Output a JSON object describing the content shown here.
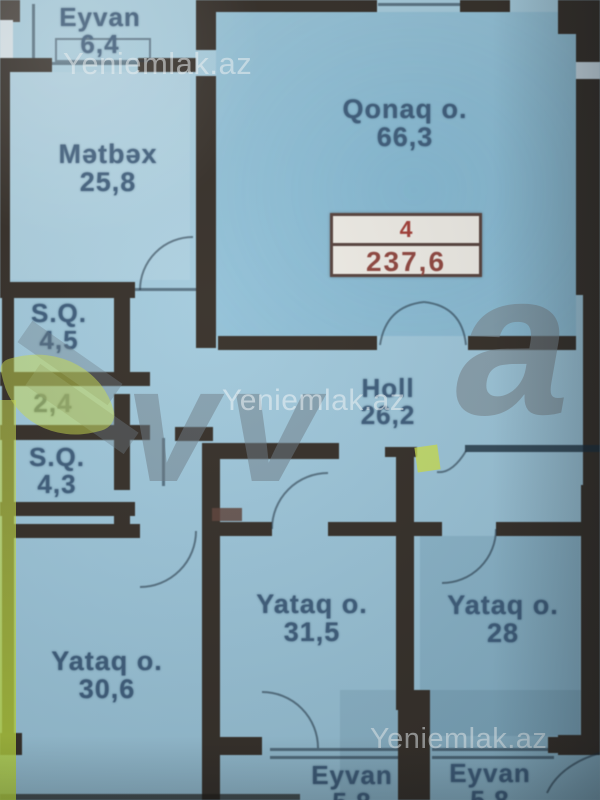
{
  "watermark": {
    "site": "Yeniemlak.az",
    "logo_v": "v",
    "logo_a": "a"
  },
  "badge": {
    "line1": "4",
    "line2": "237,6"
  },
  "rooms": {
    "eyvan_top": {
      "name": "Eyvan",
      "area": "6,4"
    },
    "metbex": {
      "name": "Mətbəx",
      "area": "25,8"
    },
    "qonaq": {
      "name": "Qonaq o.",
      "area": "66,3"
    },
    "sq1": {
      "name": "S.Q.",
      "area": "4,5"
    },
    "dehliz": {
      "area": "2,4"
    },
    "sq2": {
      "name": "S.Q.",
      "area": "4,3"
    },
    "holl": {
      "name": "Holl",
      "area": "26,2"
    },
    "yataq_center": {
      "name": "Yataq o.",
      "area": "31,5"
    },
    "yataq_right": {
      "name": "Yataq o.",
      "area": "28"
    },
    "yataq_left": {
      "name": "Yataq o.",
      "area": "30,6"
    },
    "eyvan_bottom_left": {
      "name": "Eyvan",
      "area": "5,8"
    },
    "eyvan_bottom_right": {
      "name": "Eyvan",
      "area": "5,8"
    }
  },
  "colors": {
    "wall": "#342d26",
    "label": "#3d5c7a",
    "watermark": "rgba(244,250,252,0.55)",
    "logo_gray": "rgba(108,122,132,0.5)",
    "logo_green": "rgba(205,224,75,0.78)",
    "badge_bg": "#efece5",
    "badge_border": "#55403a",
    "badge_text1": "#a23b33",
    "badge_text2": "#8f443c",
    "door_leaf": "#5e4238"
  }
}
